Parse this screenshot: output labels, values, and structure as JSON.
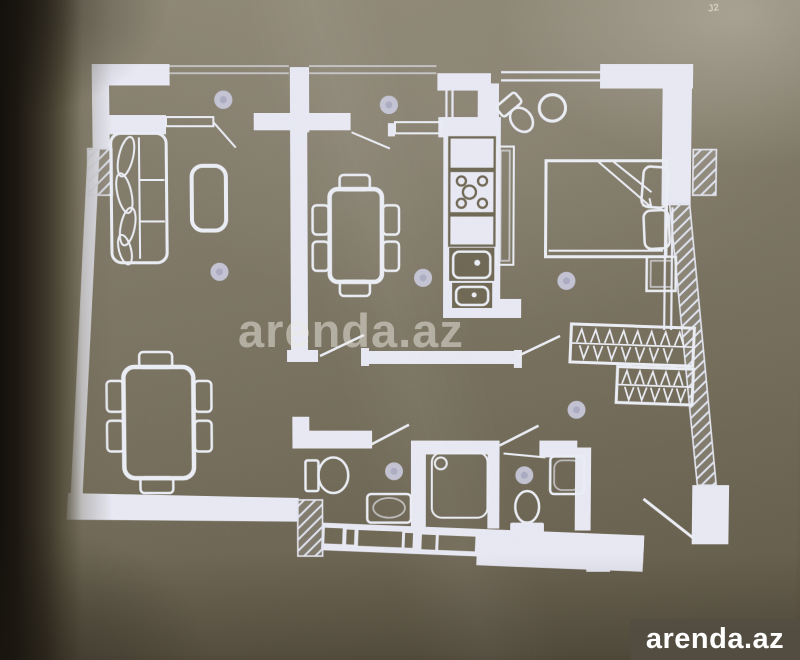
{
  "page_marker": {
    "text": "J2"
  },
  "watermark": {
    "text": "arenda.az"
  },
  "logo": {
    "text": "arenda.az"
  },
  "colors": {
    "paper": "#766f5c",
    "paper_light": "#908977",
    "paper_dark": "#5d5646",
    "gutter_shadow": "#14110c",
    "plan_line": "#e8e9f4",
    "badge": "#c9c9dc",
    "logo_bg": "#544d42",
    "logo_text": "#ffffff",
    "watermark_text": "rgba(236,233,226,0.5)"
  },
  "plan": {
    "type": "apartment-floor-plan",
    "rooms": [
      {
        "name": "living-room",
        "furniture": [
          "sofa",
          "coffee-table"
        ]
      },
      {
        "name": "dining-area",
        "furniture": [
          "dining-table-6-chairs"
        ]
      },
      {
        "name": "kitchen",
        "furniture": [
          "counter",
          "stove-4-burners",
          "counter",
          "sink",
          "sink",
          "tall-cabinet"
        ]
      },
      {
        "name": "bedroom",
        "furniture": [
          "double-bed",
          "pillows",
          "bedside-table",
          "corner-toilet",
          "round-table"
        ]
      },
      {
        "name": "second-room",
        "furniture": [
          "dining-table-6-chairs"
        ]
      },
      {
        "name": "balcony-left",
        "furniture": []
      },
      {
        "name": "balcony-right",
        "furniture": []
      },
      {
        "name": "wardrobe-corridor",
        "furniture": [
          "hanger-rack",
          "hanger-rack"
        ]
      },
      {
        "name": "bathroom-1",
        "furniture": [
          "toilet",
          "washbasin"
        ]
      },
      {
        "name": "shower-room",
        "furniture": [
          "shower-cabin"
        ]
      },
      {
        "name": "bathroom-2",
        "furniture": [
          "toilet",
          "washbasin",
          "shelf"
        ]
      }
    ],
    "room_marker_count": 8,
    "doors": 7,
    "windows": 4
  }
}
